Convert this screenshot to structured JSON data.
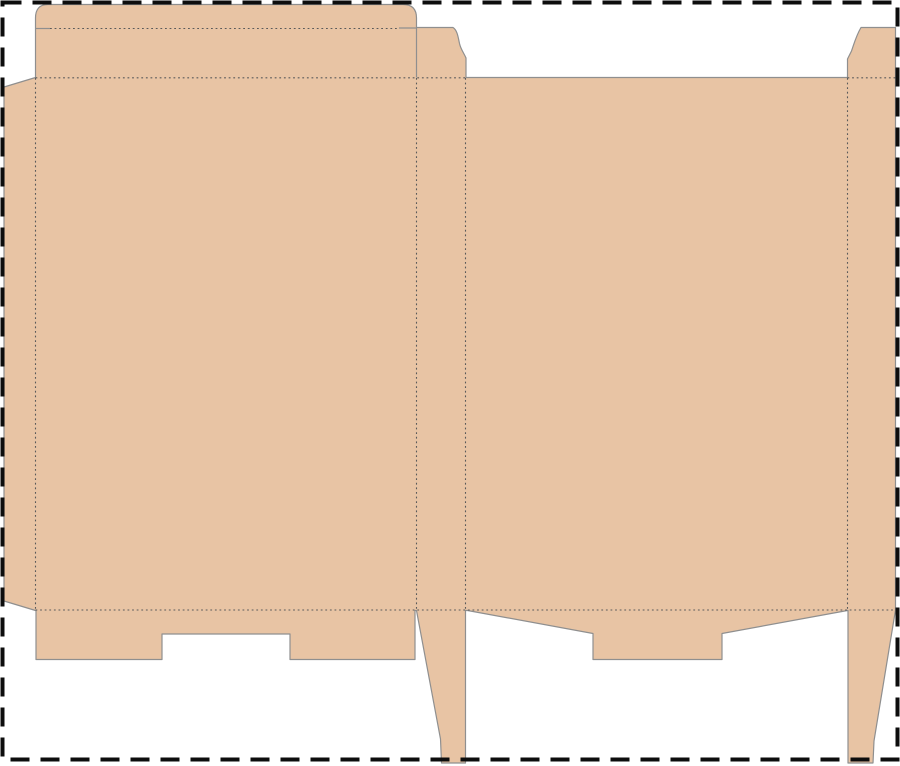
{
  "canvas": {
    "background_color": "#ffffff",
    "border_color": "#0d0d0d"
  },
  "dieline": {
    "board_color": "#e8c4a4",
    "cut_line_color": "#8f8f8f",
    "fold_line_color": "#5a5a5a"
  }
}
